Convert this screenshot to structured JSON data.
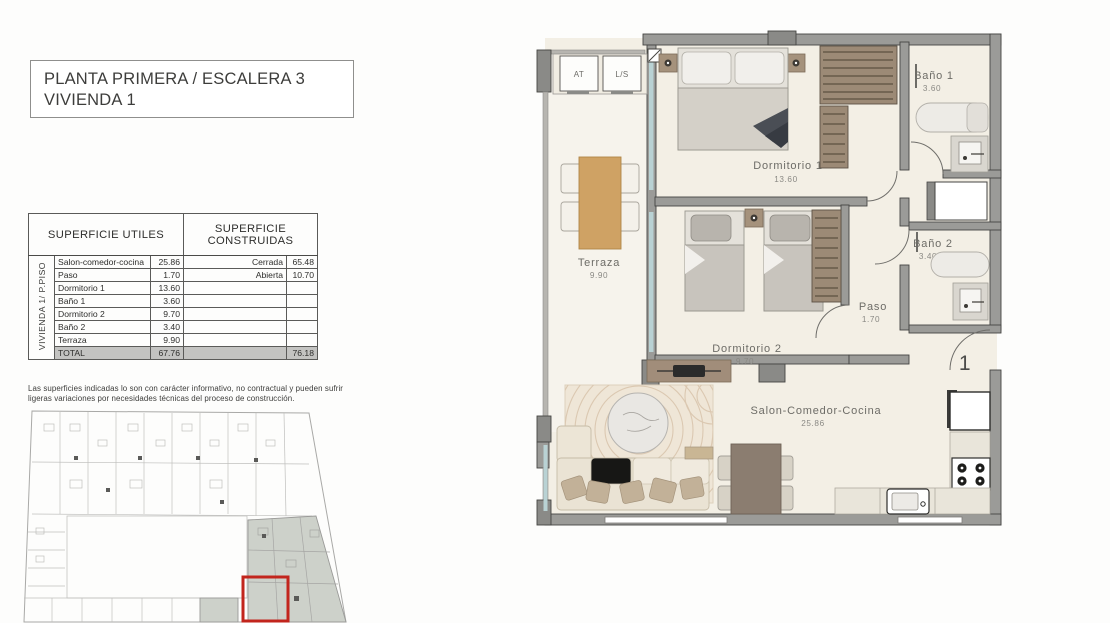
{
  "title": {
    "line1": "PLANTA PRIMERA / ESCALERA 3",
    "line2": "VIVIENDA 1"
  },
  "table": {
    "col_utiles": "SUPERFICIE UTILES",
    "col_construidas_1": "SUPERFICIE",
    "col_construidas_2": "CONSTRUIDAS",
    "row_label": "VIVIENDA 1/ P.PISO",
    "rows": [
      {
        "name": "Salon-comedor-cocina",
        "value": "25.86",
        "cname": "Cerrada",
        "cvalue": "65.48"
      },
      {
        "name": "Paso",
        "value": "1.70",
        "cname": "Abierta",
        "cvalue": "10.70"
      },
      {
        "name": "Dormitorio 1",
        "value": "13.60",
        "cname": "",
        "cvalue": ""
      },
      {
        "name": "Baño 1",
        "value": "3.60",
        "cname": "",
        "cvalue": ""
      },
      {
        "name": "Dormitorio 2",
        "value": "9.70",
        "cname": "",
        "cvalue": ""
      },
      {
        "name": "Baño 2",
        "value": "3.40",
        "cname": "",
        "cvalue": ""
      },
      {
        "name": "Terraza",
        "value": "9.90",
        "cname": "",
        "cvalue": ""
      }
    ],
    "total": {
      "name": "TOTAL",
      "value": "67.76",
      "cname": "",
      "cvalue": "76.18"
    }
  },
  "disclaimer_line1": "Las superficies indicadas lo son con carácter informativo, no contractual y pueden sufrir",
  "disclaimer_line2": "ligeras variaciones por necesidades técnicas del proceso de construcción.",
  "plan": {
    "rooms": {
      "dormitorio1": {
        "name": "Dormitorio 1",
        "area": "13.60"
      },
      "dormitorio2": {
        "name": "Dormitorio 2",
        "area": "9.70"
      },
      "bano1": {
        "name": "Baño 1",
        "area": "3.60"
      },
      "bano2": {
        "name": "Baño 2",
        "area": "3.40"
      },
      "terraza": {
        "name": "Terraza",
        "area": "9.90"
      },
      "paso": {
        "name": "Paso",
        "area": "1.70"
      },
      "salon": {
        "name": "Salon-Comedor-Cocina",
        "area": "25.86"
      }
    },
    "labels": {
      "at": "AT",
      "ls": "L/S",
      "unit_number": "1"
    }
  },
  "colors": {
    "wall": "#9b9b98",
    "wall_dark": "#868684",
    "floor": "#f3efe5",
    "floor_terrace": "#f6f3ec",
    "window": "#b9d2d4",
    "wood": "#cfa264",
    "taupe": "#8b7d70",
    "highlight_red": "#c2251d",
    "minimap_shade": "#cdd1ca"
  }
}
